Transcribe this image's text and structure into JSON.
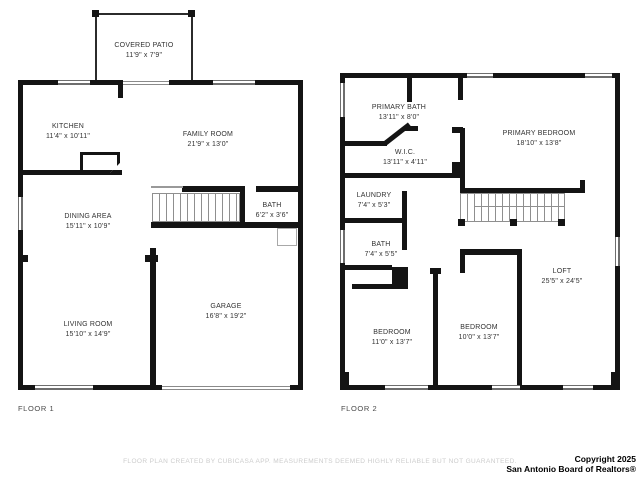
{
  "floor1": {
    "name": "FLOOR 1",
    "rooms": {
      "covered_patio": {
        "label": "COVERED PATIO",
        "dims": "11'9\" x 7'9\""
      },
      "kitchen": {
        "label": "KITCHEN",
        "dims": "11'4\" x 10'11\""
      },
      "family_room": {
        "label": "FAMILY ROOM",
        "dims": "21'9\" x 13'0\""
      },
      "dining_area": {
        "label": "DINING AREA",
        "dims": "15'11\" x 10'9\""
      },
      "bath": {
        "label": "BATH",
        "dims": "6'2\" x 3'6\""
      },
      "living_room": {
        "label": "LIVING ROOM",
        "dims": "15'10\" x 14'9\""
      },
      "garage": {
        "label": "GARAGE",
        "dims": "16'8\" x 19'2\""
      }
    }
  },
  "floor2": {
    "name": "FLOOR 2",
    "rooms": {
      "primary_bath": {
        "label": "PRIMARY BATH",
        "dims": "13'11\" x 8'0\""
      },
      "wic": {
        "label": "W.I.C.",
        "dims": "13'11\" x 4'11\""
      },
      "primary_bedroom": {
        "label": "PRIMARY BEDROOM",
        "dims": "18'10\" x 13'8\""
      },
      "laundry": {
        "label": "LAUNDRY",
        "dims": "7'4\" x 5'3\""
      },
      "bath": {
        "label": "BATH",
        "dims": "7'4\" x 5'5\""
      },
      "bedroom_left": {
        "label": "BEDROOM",
        "dims": "11'0\" x 13'7\""
      },
      "bedroom_mid": {
        "label": "BEDROOM",
        "dims": "10'0\" x 13'7\""
      },
      "loft": {
        "label": "LOFT",
        "dims": "25'5\" x 24'5\""
      }
    }
  },
  "footer": {
    "disclaimer": "FLOOR PLAN CREATED BY CUBICASA APP. MEASUREMENTS DEEMED HIGHLY RELIABLE BUT NOT GUARANTEED.",
    "copyright_line1": "Copyright 2025",
    "copyright_line2": "San Antonio Board of Realtors®"
  },
  "colors": {
    "wall": "#141414",
    "label_text": "#323232",
    "disclaimer_text": "#cccccc"
  }
}
